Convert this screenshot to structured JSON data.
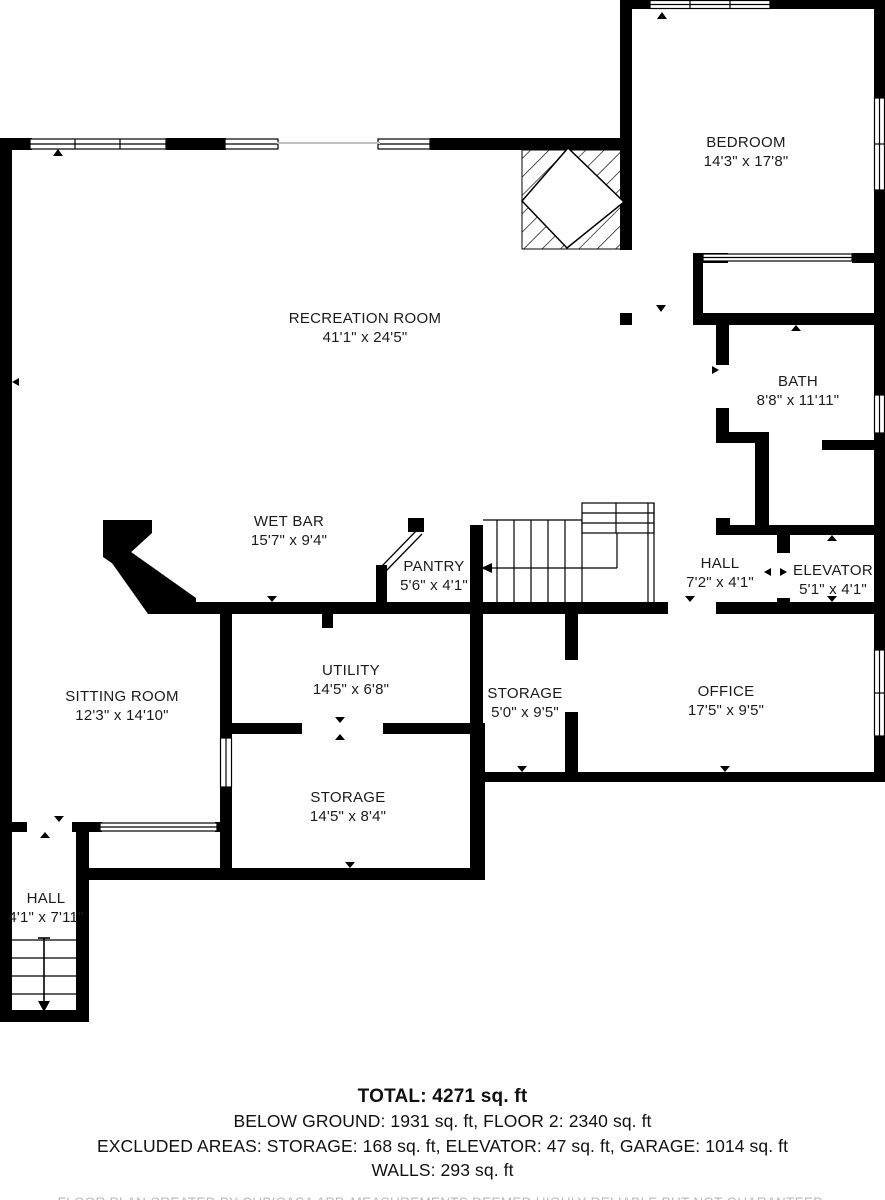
{
  "plan": {
    "type": "floor-plan",
    "rooms": [
      {
        "name": "BEDROOM",
        "dims": "14'3\" x 17'8\"",
        "cx": 746,
        "cy": 152
      },
      {
        "name": "RECREATION ROOM",
        "dims": "41'1\" x 24'5\"",
        "cx": 365,
        "cy": 328
      },
      {
        "name": "BATH",
        "dims": "8'8\" x 11'11\"",
        "cx": 798,
        "cy": 391
      },
      {
        "name": "WET BAR",
        "dims": "15'7\" x 9'4\"",
        "cx": 289,
        "cy": 531
      },
      {
        "name": "PANTRY",
        "dims": "5'6\" x 4'1\"",
        "cx": 434,
        "cy": 576
      },
      {
        "name": "HALL",
        "dims": "7'2\" x 4'1\"",
        "cx": 720,
        "cy": 573
      },
      {
        "name": "ELEVATOR",
        "dims": "5'1\" x 4'1\"",
        "cx": 833,
        "cy": 580
      },
      {
        "name": "SITTING ROOM",
        "dims": "12'3\" x 14'10\"",
        "cx": 122,
        "cy": 706
      },
      {
        "name": "UTILITY",
        "dims": "14'5\" x 6'8\"",
        "cx": 351,
        "cy": 680
      },
      {
        "name": "STORAGE",
        "dims": "5'0\" x 9'5\"",
        "cx": 525,
        "cy": 703
      },
      {
        "name": "OFFICE",
        "dims": "17'5\" x 9'5\"",
        "cx": 726,
        "cy": 701
      },
      {
        "name": "STORAGE",
        "dims": "14'5\" x 8'4\"",
        "cx": 348,
        "cy": 807
      },
      {
        "name": "HALL",
        "dims": "4'1\" x 7'11\"",
        "cx": 46,
        "cy": 908
      }
    ],
    "colors": {
      "wall": "#000000",
      "label_text": "#1b1b1b",
      "disclaimer_text": "#b9b9b9"
    }
  },
  "footer": {
    "total": "TOTAL: 4271 sq. ft",
    "areas_line": "BELOW GROUND: 1931 sq. ft, FLOOR 2: 2340 sq. ft",
    "excluded_line": "EXCLUDED AREAS: STORAGE: 168 sq. ft, ELEVATOR: 47 sq. ft, GARAGE: 1014 sq. ft",
    "walls_line": "WALLS: 293 sq. ft",
    "disclaimer": "FLOOR PLAN CREATED BY CUBICASA APP. MEASUREMENTS DEEMED HIGHLY RELIABLE BUT NOT GUARANTEED."
  }
}
